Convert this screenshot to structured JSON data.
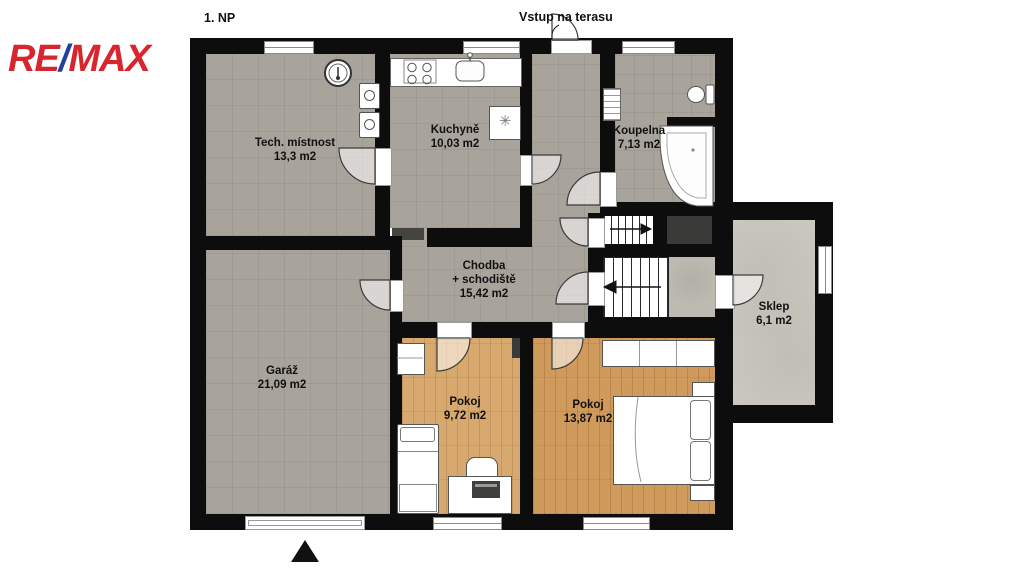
{
  "header": {
    "floor_label": "1. NP",
    "terrace_label": "Vstup na terasu"
  },
  "logo": {
    "re": "RE",
    "slash": "/",
    "max": "MAX"
  },
  "rooms": [
    {
      "id": "tech",
      "name": "Tech. místnost",
      "area": "13,3 m2"
    },
    {
      "id": "kuchyne",
      "name": "Kuchyně",
      "area": "10,03 m2"
    },
    {
      "id": "koupelna",
      "name": "Koupelna",
      "area": "7,13 m2"
    },
    {
      "id": "chodba",
      "name": "Chodba",
      "name2": "+ schodiště",
      "area": "15,42 m2"
    },
    {
      "id": "garaz",
      "name": "Garáž",
      "area": "21,09 m2"
    },
    {
      "id": "pokoj1",
      "name": "Pokoj",
      "area": "9,72 m2"
    },
    {
      "id": "pokoj2",
      "name": "Pokoj",
      "area": "13,87 m2"
    },
    {
      "id": "sklep",
      "name": "Sklep",
      "area": "6,1 m2"
    }
  ],
  "icons": {
    "fridge_glyph": "✳"
  },
  "colors": {
    "wall": "#0d0d0d",
    "tile": "#a8a39b",
    "wood_small": "#d7a96f",
    "wood_large": "#cf9a5b",
    "concrete": "#cbc8bf",
    "landing": "#bdbab1",
    "dark_fixture": "#3a3a38",
    "frame": "#8a8a8a",
    "logo_red": "#d9252e",
    "logo_blue": "#23409a"
  }
}
